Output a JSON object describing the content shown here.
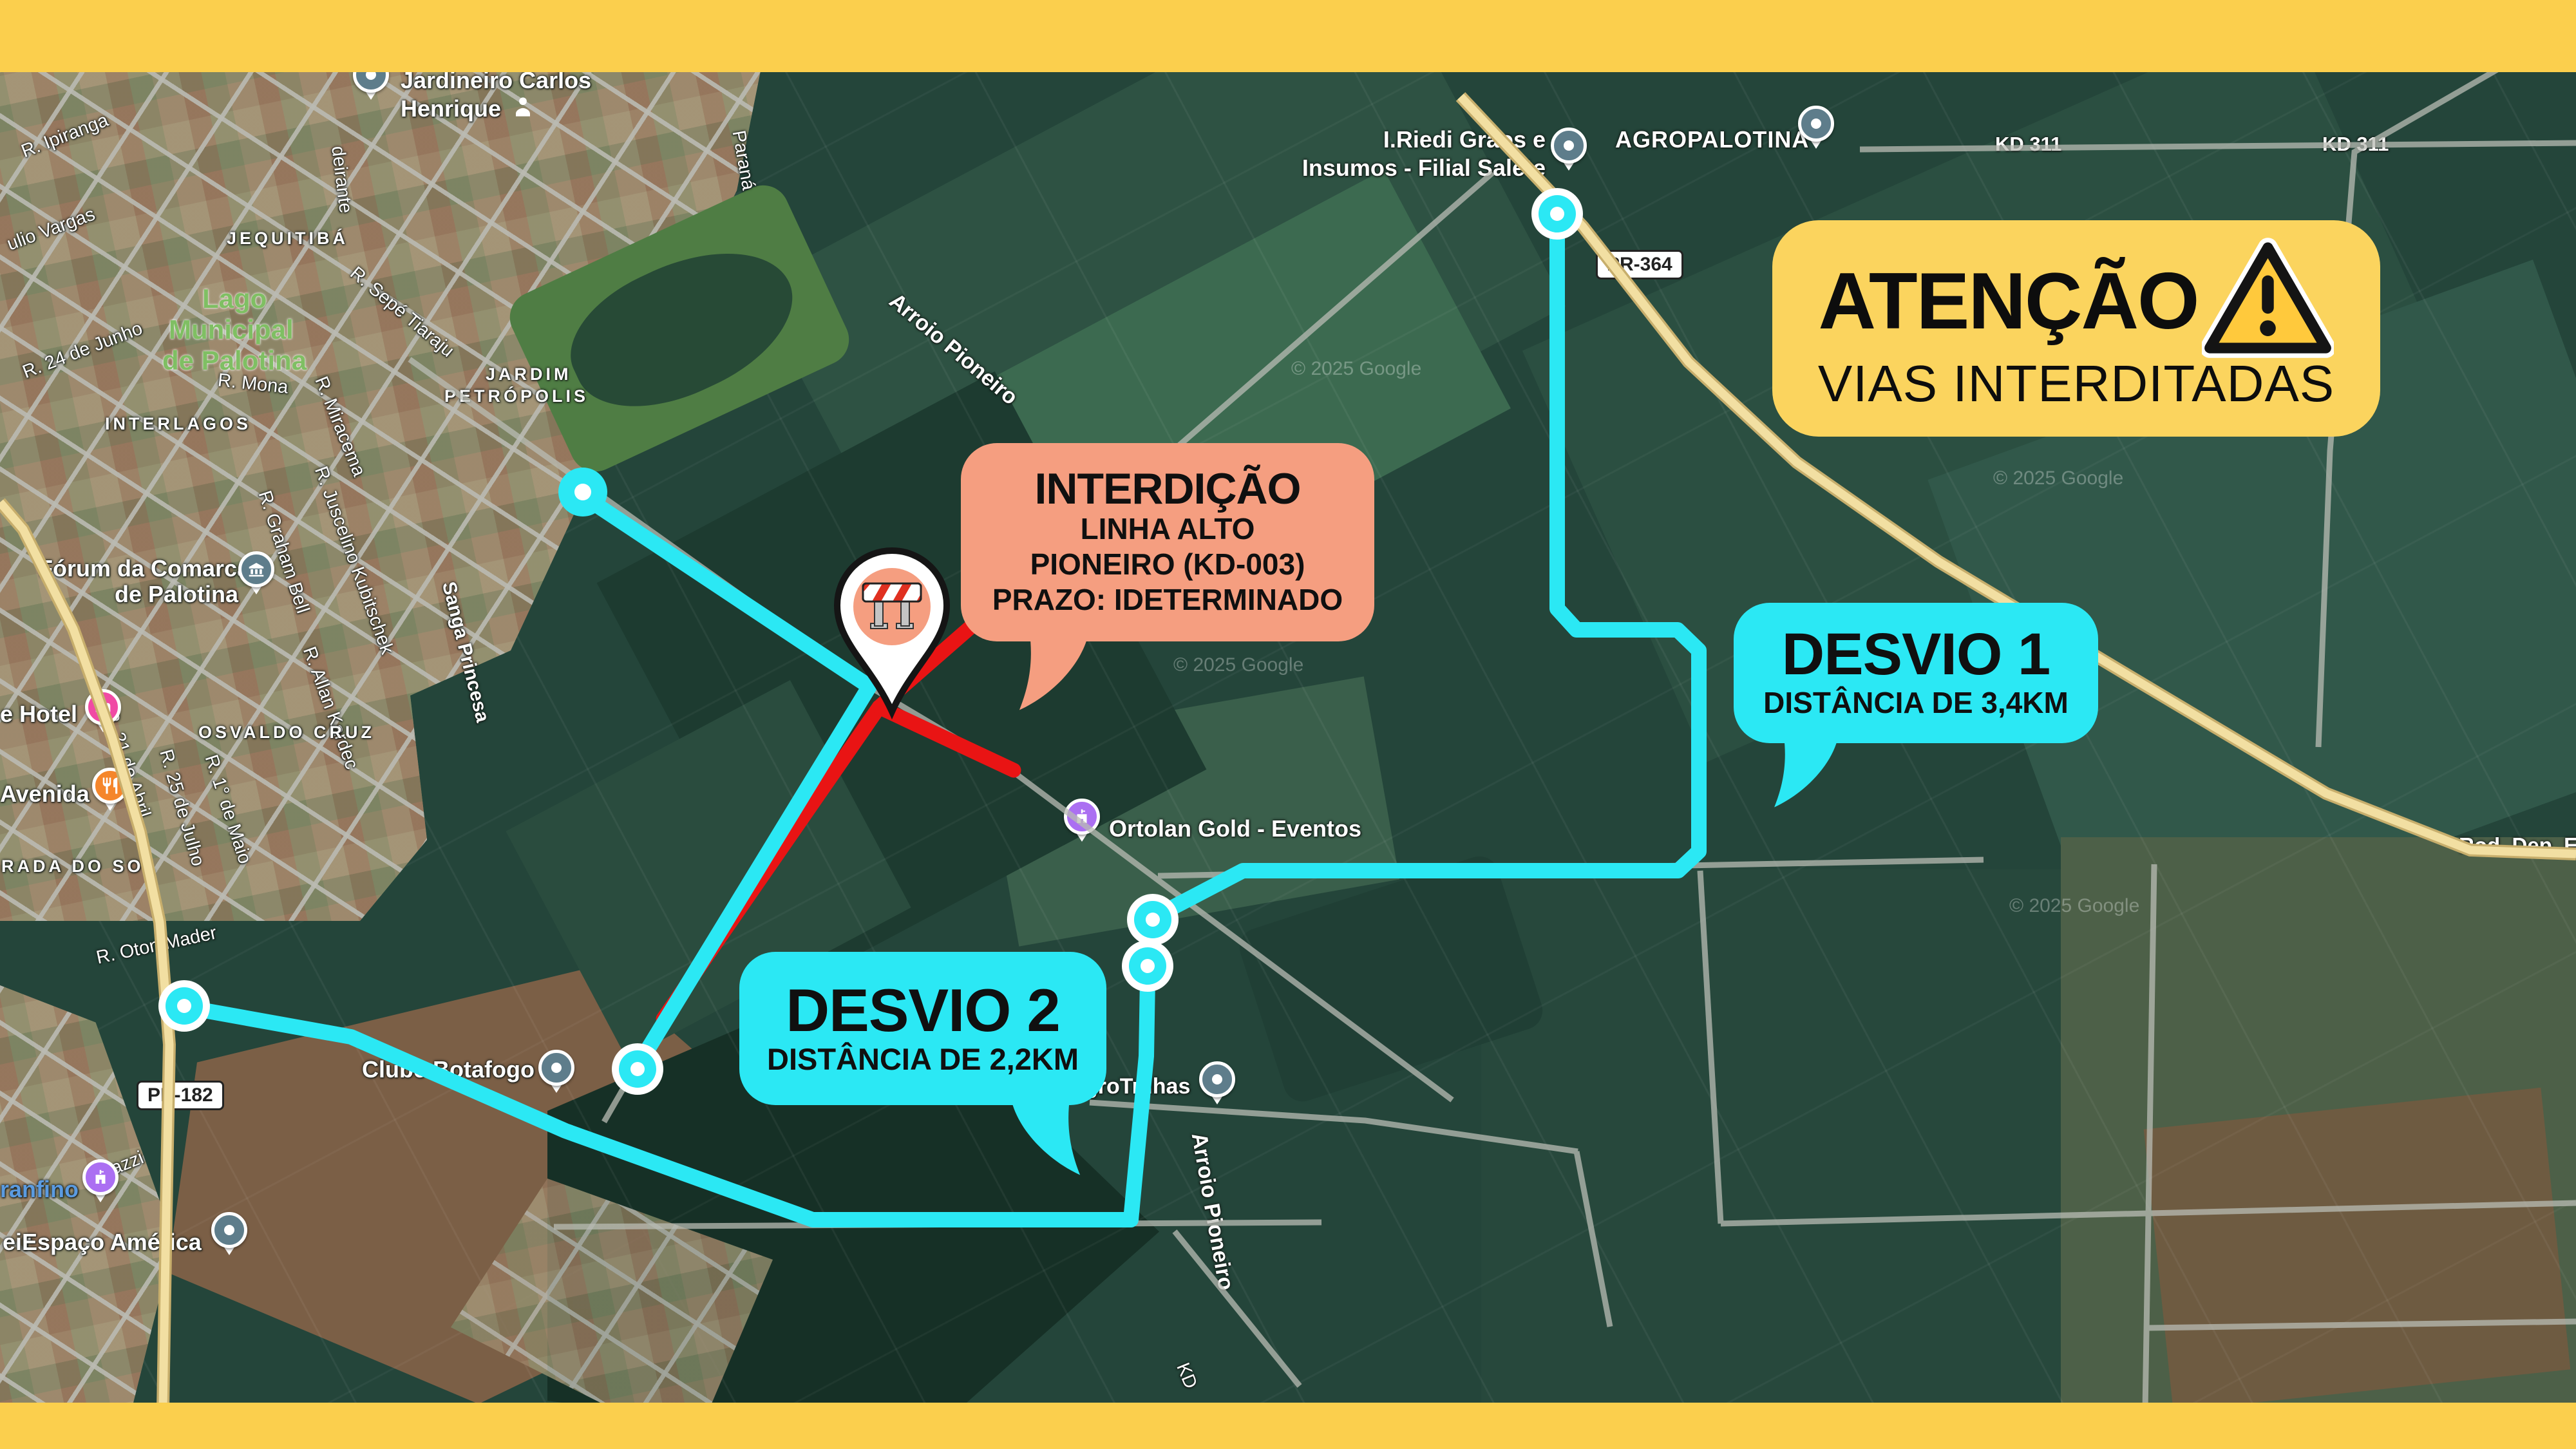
{
  "banner": {
    "title": "ATENÇÃO",
    "subtitle": "VIAS INTERDITADAS",
    "icon": "warning-triangle-icon"
  },
  "bubbles": {
    "interdicao": {
      "title": "INTERDIÇÃO",
      "line1": "LINHA ALTO",
      "line2": "PIONEIRO (KD-003)",
      "line3": "PRAZO: IDETERMINADO"
    },
    "desvio1": {
      "title": "DESVIO 1",
      "subtitle": "DISTÂNCIA DE 3,4KM"
    },
    "desvio2": {
      "title": "DESVIO 2",
      "subtitle": "DISTÂNCIA DE 2,2KM"
    }
  },
  "shields": {
    "pr182": "PR-182",
    "pr364": "PR-364"
  },
  "watermark": "© 2025 Google",
  "colors": {
    "frame_yellow": "#fbcf4d",
    "banner_yellow": "#fbd45e",
    "route_cyan": "#2be8f4",
    "closed_red": "#e91414",
    "alert_salmon": "#f59e80",
    "pin_slate": "#5e7d8b",
    "pin_pink": "#f04aa4",
    "pin_orange": "#f5862b",
    "pin_purple": "#ab6ff2"
  },
  "labels": {
    "streets": {
      "ipiranga": "R. Ipiranga",
      "vargas": "ulio Vargas",
      "junho24": "R. 24 de Junho",
      "sepe": "R. Sepé Tiaraju",
      "miracema": "R. Miracema",
      "parana": "Paraná",
      "deirante": "deirante",
      "juscelino": "R. Juscelino Kubitschek",
      "graham": "R. Graham Bell",
      "abril21": "R. 21 de Abril",
      "julho25": "R. 25 de Julho",
      "maio1": "R. 1° de Maio",
      "allan": "R. Allan Kardec",
      "mona": "R. Mona",
      "oton": "R. Oton Mader",
      "azzi": "azzi",
      "eir": "eir",
      "kd": "KD",
      "kd311": "KD 311",
      "roddep": "Rod. Dep. Ed"
    },
    "areas": {
      "jequitiba": "JEQUITIBÁ",
      "interlagos": "INTERLAGOS",
      "osvaldo": "OSVALDO CRUZ",
      "radadosol": "RADA DO SOL",
      "jardim1": "JARDIM",
      "jardim2": "PETRÓPOLIS"
    },
    "water": {
      "arroio": "Arroio Pioneiro",
      "sanga": "Sanga Princesa"
    },
    "park": {
      "l1": "Lago",
      "l2": "Municipal",
      "l3": "de Palotina"
    },
    "places": {
      "jardineiro1": "Jardineiro Carlos",
      "jardineiro2": "Henrique",
      "iriedi1": "I.Riedi Grãos e",
      "iriedi2": "Insumos - Filial Salete",
      "agropalotina": "AGROPALOTINA",
      "ortolan": "Ortolan Gold - Eventos",
      "agrotrilhas": "groTrilhas",
      "clube": "Clube Botafogo",
      "espaco": "Espaço América",
      "granfino": "ranfino",
      "forum1": "Fórum da Comarca",
      "forum2": "de Palotina",
      "hotel": "e Hotel",
      "avenida": "Avenida"
    }
  }
}
